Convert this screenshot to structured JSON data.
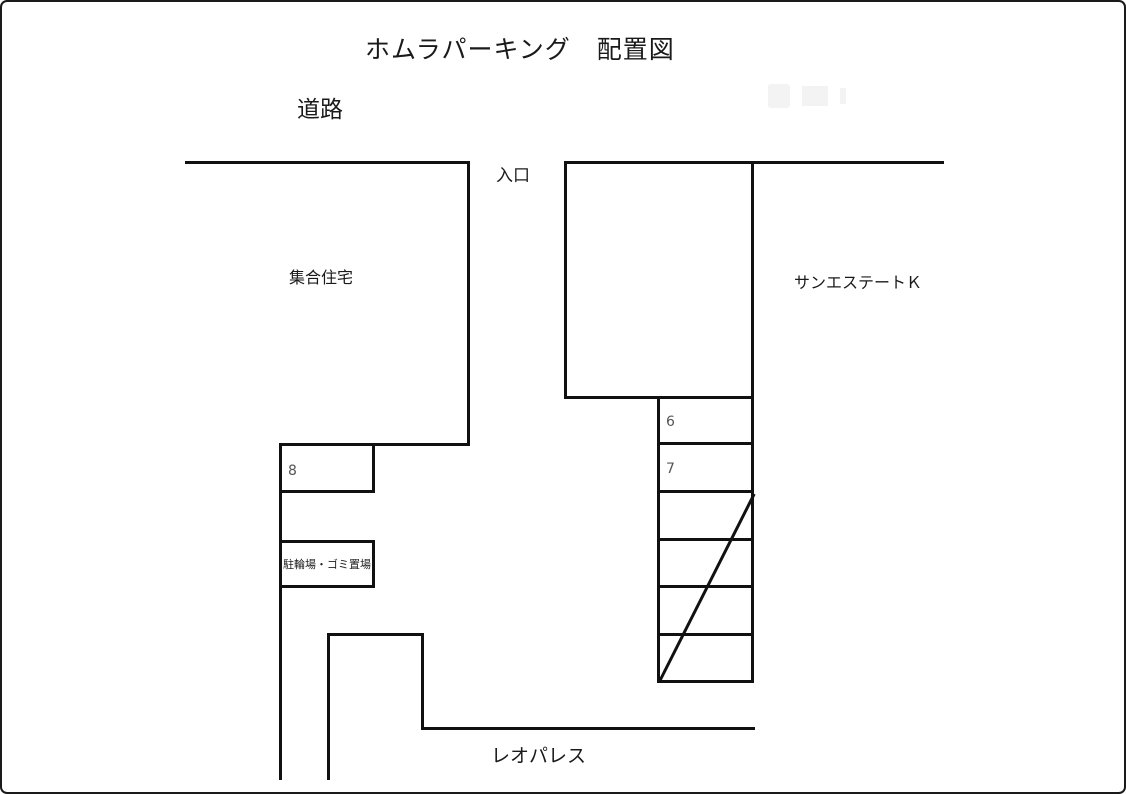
{
  "title": "ホムラパーキング　配置図",
  "labels": {
    "road": "道路",
    "entrance": "入口",
    "apartment": "集合住宅",
    "owner_house": "オーナー宅",
    "neighbor_east": "サンエステートＫ",
    "neighbor_south": "レオパレス",
    "bicycle_garbage": "駐輪場・ゴミ置場"
  },
  "parking_spots": {
    "left_column": [
      "8"
    ],
    "right_column": [
      "6",
      "7",
      "",
      "",
      "",
      ""
    ],
    "crossed_out_note": "diagonal-line-through-4-lower-right-spots"
  },
  "colors": {
    "line": "#111111",
    "number_text": "#555555",
    "background": "#ffffff",
    "border": "#1a1a1a"
  }
}
